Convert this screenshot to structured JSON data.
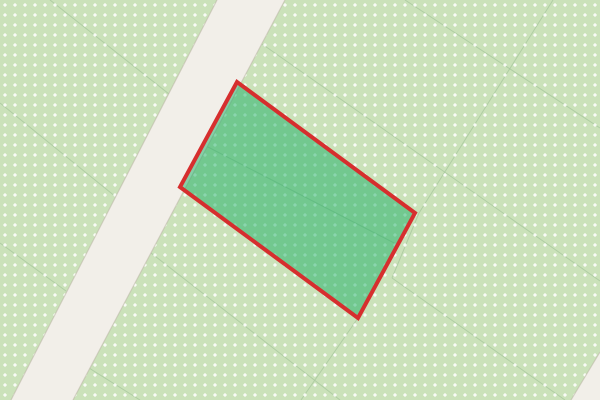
{
  "map": {
    "width": 600,
    "height": 400,
    "colors": {
      "landcover_green": "#cbe2ba",
      "road_fill": "#f2efe9",
      "road_casing": "rgba(185,180,164,0.55)",
      "boundary_line": "#a9c89e",
      "dot": "rgba(255,255,255,0.8)",
      "parcel_fill": "rgba(16,172,96,0.48)",
      "parcel_stroke": "#d62e2e"
    },
    "dot_pattern": {
      "spacing": 10,
      "h_rect": {
        "x": 3.2,
        "y": 4.2,
        "w": 3.6,
        "h": 1.6
      },
      "v_rect": {
        "x": 4.2,
        "y": 3.2,
        "w": 1.6,
        "h": 3.6
      }
    },
    "main_road": {
      "points": "217,0 285,0 73,400 11,400",
      "left_edge": {
        "x1": 217,
        "y1": 0,
        "x2": 11,
        "y2": 400
      },
      "right_edge": {
        "x1": 285,
        "y1": 0,
        "x2": 73,
        "y2": 400
      },
      "casing_width": 1.2
    },
    "corner_road": {
      "points": "600,352 600,400 571,400",
      "edge": {
        "x1": 600,
        "y1": 352,
        "x2": 571,
        "y2": 400
      }
    },
    "boundary_lines": {
      "a": {
        "x1": 50,
        "y1": 0,
        "x2": 169,
        "y2": 94
      },
      "b": {
        "x1": 0,
        "y1": 103,
        "x2": 116,
        "y2": 197
      },
      "c": {
        "x1": 0,
        "y1": 243,
        "x2": 66,
        "y2": 291
      },
      "d": {
        "x1": 262,
        "y1": 44,
        "x2": 600,
        "y2": 281
      },
      "e": {
        "x1": 405,
        "y1": 0,
        "x2": 600,
        "y2": 128
      },
      "f": {
        "x1": 553,
        "y1": 0,
        "x2": 419,
        "y2": 213
      },
      "g": {
        "x1": 419,
        "y1": 213,
        "x2": 392,
        "y2": 278
      },
      "h": {
        "x1": 392,
        "y1": 278,
        "x2": 565,
        "y2": 400
      },
      "i": {
        "x1": 89,
        "y1": 368,
        "x2": 140,
        "y2": 400
      },
      "j": {
        "x1": 206,
        "y1": 146,
        "x2": 398,
        "y2": 245
      },
      "k": {
        "x1": 358,
        "y1": 318,
        "x2": 301,
        "y2": 400
      },
      "l": {
        "x1": 151,
        "y1": 253,
        "x2": 340,
        "y2": 400
      }
    },
    "selected_parcel": {
      "points": "237,82 415,213 358,318 180,187",
      "stroke_width": 4
    }
  }
}
